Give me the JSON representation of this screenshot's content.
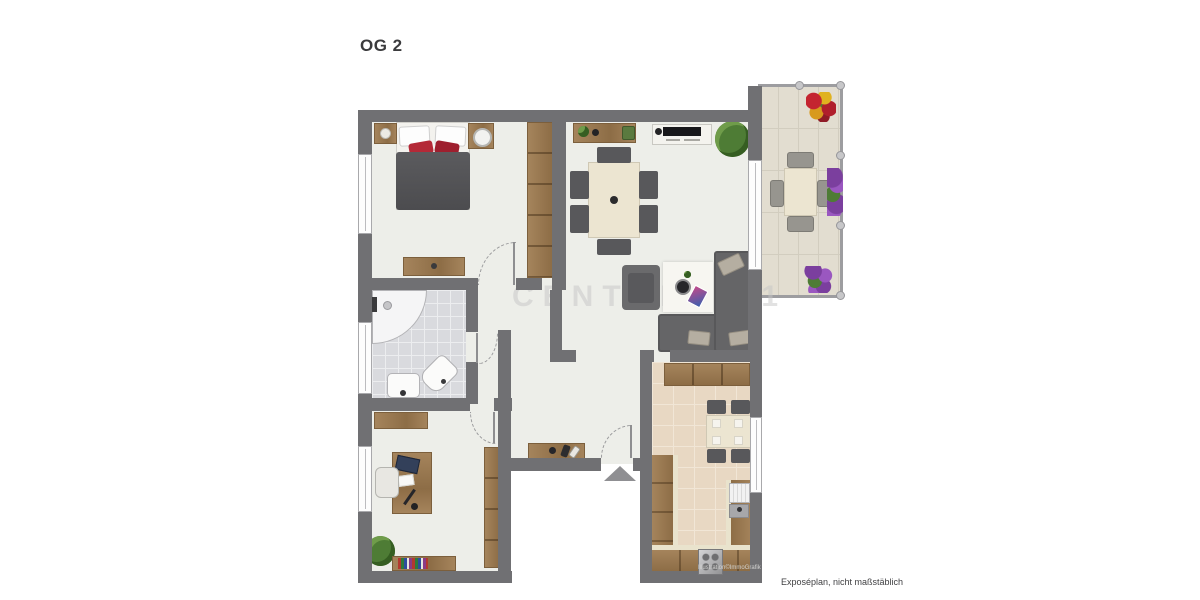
{
  "title": "OG 2",
  "watermark": "CENTURY 21",
  "footer": {
    "illustration_credit": "Illustration©ImmoGrafik",
    "disclaimer": "Exposéplan, nicht maßstäblich"
  },
  "colors": {
    "wall": "#707073",
    "floor": "#edeee9",
    "bath_tile": "#d9dade",
    "bath_grout": "#ecedef",
    "kitchen_tile": "#e8d8c3",
    "kitchen_grout": "#f1e6d6",
    "balcony_tile": "#e2ddd0",
    "balcony_grout": "#d2cdbf",
    "wood": "#a5845c",
    "wood_dark": "#8d6d46",
    "dark_furniture": "#58585b",
    "sofa": "#656567",
    "cream": "#ece5d1",
    "counter_cream": "#e9e3cd",
    "accent_red": "#b42937",
    "plant": "#4e7c35",
    "arc": "#9b9b9d"
  },
  "icons": [
    "double-bed",
    "nightstand",
    "dresser",
    "wardrobe",
    "sideboard",
    "tv-lowboard",
    "potted-plant",
    "dining-table",
    "chair",
    "armchair",
    "corner-sofa",
    "rug",
    "coffee-table",
    "corner-shower",
    "washbasin",
    "toilet",
    "desk",
    "laptop",
    "office-chair",
    "bookshelf",
    "shoe-bench",
    "kitchen-counter",
    "kitchen-sink",
    "dishwasher",
    "stove",
    "balcony-table",
    "flower-box",
    "entrance-arrow",
    "door-swing",
    "window",
    "balcony-railing"
  ]
}
